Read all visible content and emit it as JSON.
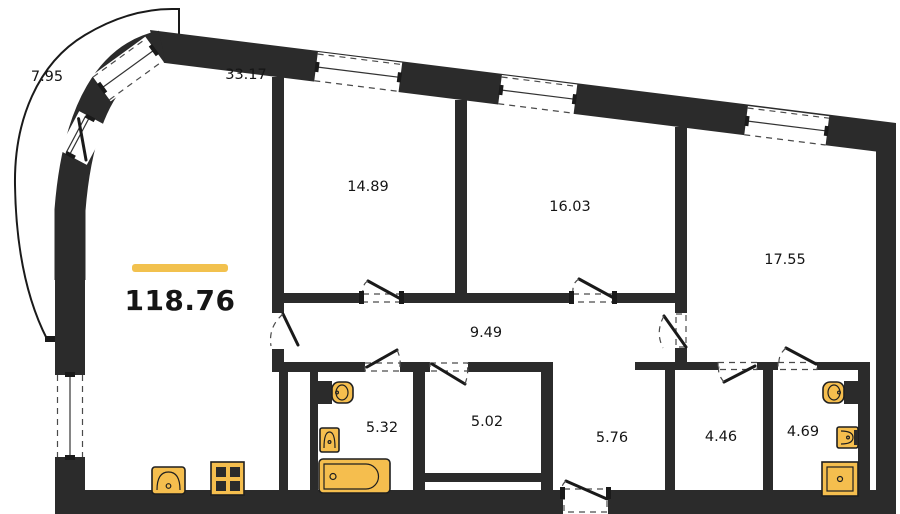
{
  "floorplan": {
    "total": {
      "area": "118.76"
    },
    "rooms": [
      {
        "name": "balcony",
        "area": "7.95"
      },
      {
        "name": "living-kitchen",
        "area": "33.17"
      },
      {
        "name": "bedroom-1",
        "area": "14.89"
      },
      {
        "name": "bedroom-2",
        "area": "16.03"
      },
      {
        "name": "bedroom-3",
        "area": "17.55"
      },
      {
        "name": "corridor",
        "area": "9.49"
      },
      {
        "name": "bathroom",
        "area": "5.32"
      },
      {
        "name": "storage",
        "area": "5.02"
      },
      {
        "name": "entry-hall",
        "area": "5.76"
      },
      {
        "name": "wardrobe",
        "area": "4.46"
      },
      {
        "name": "ensuite-bathroom",
        "area": "4.69"
      }
    ],
    "fixtures": [
      "bathtub",
      "toilet",
      "wash-basin",
      "kitchen-sink",
      "stove",
      "shower"
    ],
    "colors": {
      "wall": "#2b2b2b",
      "fixture_fill": "#F5BE4E",
      "accent_bar": "#F2C14E",
      "background": "#FFFFFF"
    }
  }
}
